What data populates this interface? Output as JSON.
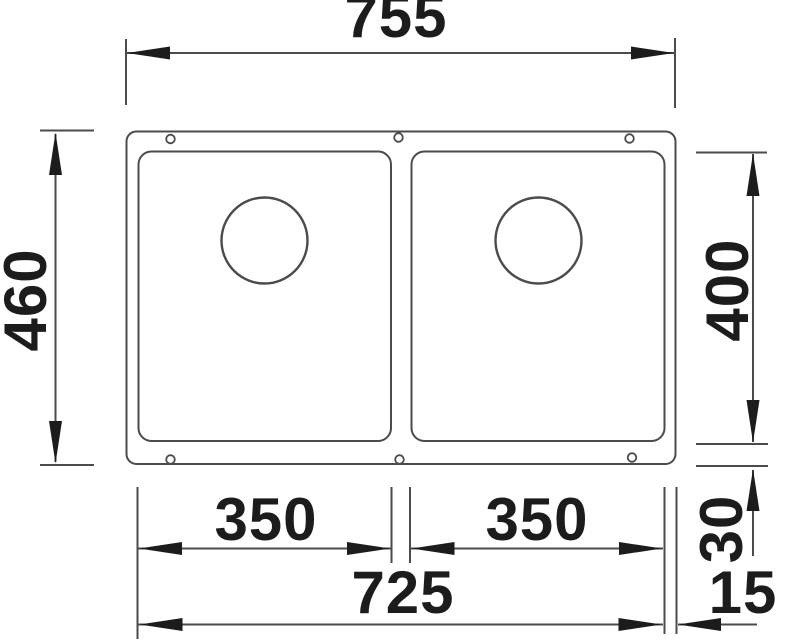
{
  "colors": {
    "line": "#4b4b4b",
    "ink": "#1c1c1c",
    "background": "#ffffff"
  },
  "dimensions": {
    "overall_width": "755",
    "overall_depth": "460",
    "bowl_depth": "400",
    "left_bowl_width": "350",
    "right_bowl_width": "350",
    "cutout_width": "725",
    "bottom_offset": "30",
    "side_offset": "15"
  }
}
